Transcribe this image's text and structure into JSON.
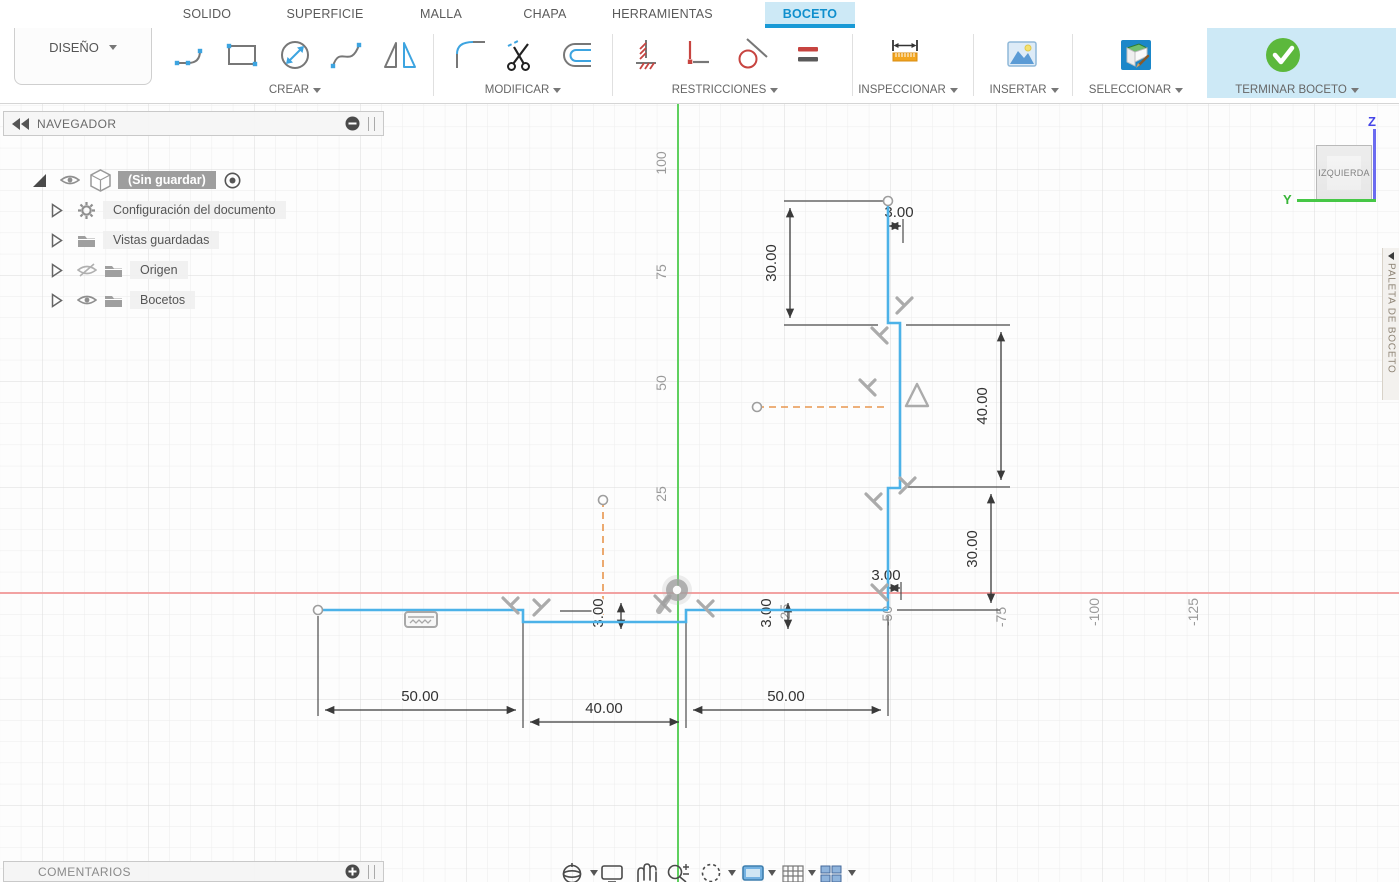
{
  "tabbar": {
    "items": [
      {
        "label": "SOLIDO"
      },
      {
        "label": "SUPERFICIE"
      },
      {
        "label": "MALLA"
      },
      {
        "label": "CHAPA"
      },
      {
        "label": "HERRAMIENTAS"
      },
      {
        "label": "BOCETO"
      }
    ],
    "active": "BOCETO"
  },
  "toolbar": {
    "design_label": "DISEÑO",
    "groups": [
      {
        "label": "CREAR"
      },
      {
        "label": "MODIFICAR"
      },
      {
        "label": "RESTRICCIONES"
      },
      {
        "label": "INSPECCIONAR"
      },
      {
        "label": "INSERTAR"
      },
      {
        "label": "SELECCIONAR"
      },
      {
        "label": "TERMINAR BOCETO"
      }
    ]
  },
  "navigator": {
    "title": "NAVEGADOR",
    "items": [
      {
        "label": "(Sin guardar)"
      },
      {
        "label": "Configuración del documento"
      },
      {
        "label": "Vistas guardadas"
      },
      {
        "label": "Origen"
      },
      {
        "label": "Bocetos"
      }
    ]
  },
  "comments": {
    "title": "COMENTARIOS"
  },
  "viewcube": {
    "face": "IZQUIERDA",
    "axis_z": "Z",
    "axis_y": "Y"
  },
  "sketch_palette": {
    "label": "PALETA DE BOCETO"
  },
  "canvas": {
    "dimensions": {
      "top_height": "30.00",
      "top_thickness": "3.00",
      "mid_height": "40.00",
      "bottom_height": "30.00",
      "bottom_thickness": "3.00",
      "left_width": "50.00",
      "mid_width": "40.00",
      "right_width": "50.00",
      "web_thickness_left": "3.00",
      "web_thickness_right": "3.00"
    },
    "axis_ticks_y": [
      "100",
      "75",
      "50",
      "25"
    ],
    "axis_ticks_x": [
      "-25",
      "-50",
      "-75",
      "-100",
      "-125"
    ],
    "colors": {
      "sketch_line": "#4cb2e8",
      "x_axis": "#f2a2a2",
      "y_axis": "#5fd05f",
      "construction": "#e8964e",
      "dimension": "#3a3a3a",
      "grid_minor": "#ececec",
      "grid_major": "#dbdbdb",
      "active_tab_bg": "#cde9f6",
      "active_tab_accent": "#199ad6",
      "finish_green": "#5cb83c"
    }
  }
}
